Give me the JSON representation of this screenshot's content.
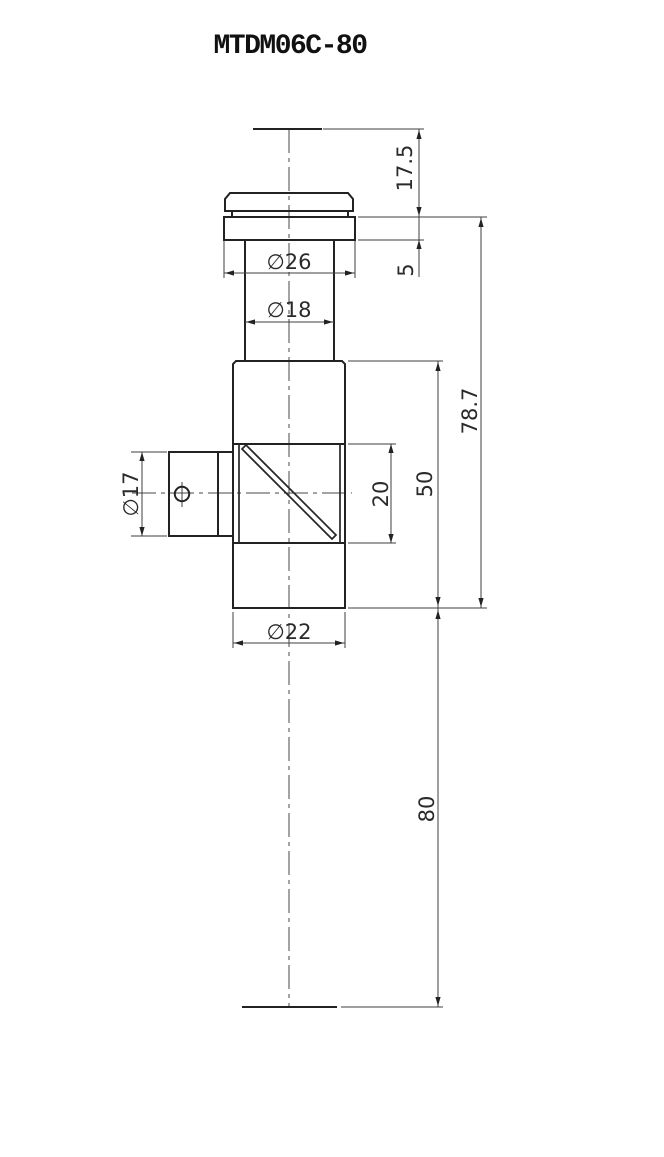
{
  "labels": {
    "title": "MTDM06C-80",
    "dim_cap_height": "17.5",
    "dim_flange_thickness": "5",
    "dim_flange_dia": "∅26",
    "dim_tube_dia": "∅18",
    "dim_overall_upper": "78.7",
    "dim_body_length": "50",
    "dim_window_height": "20",
    "dim_port_dia": "∅17",
    "dim_body_dia": "∅22",
    "dim_lower_length": "80"
  },
  "colors": {
    "background": "#ffffff",
    "outline": "#222222",
    "thin_line": "#3f3f3f",
    "text": "#2a2a2a"
  },
  "drawing": {
    "type": "engineering-dimension-drawing",
    "part": "beam-splitter tube assembly",
    "units": "mm"
  }
}
